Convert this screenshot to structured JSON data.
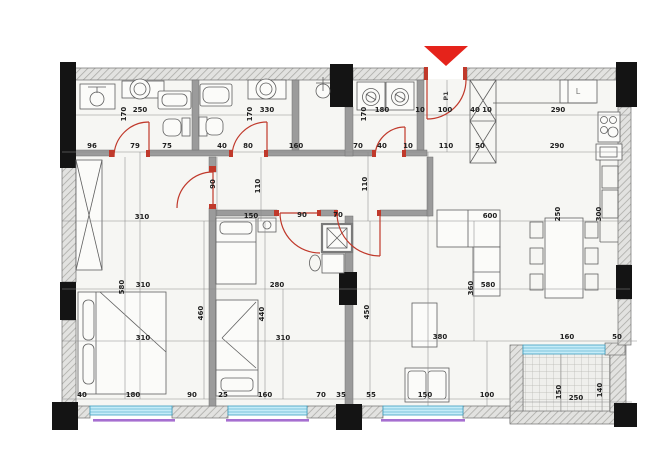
{
  "title": "Apartment floor plan drawing",
  "colors": {
    "background": "#ffffff",
    "floor": "#f6f6f3",
    "wall_hatch": "#e2e2e0",
    "wall_hatch_line": "#a8a8a4",
    "structural_column": "#141414",
    "interior_wall": "#9b9b9b",
    "door_red": "#c0392b",
    "entrance_marker_red": "#e5231b",
    "window_glass_blue": "#c5ecf8",
    "window_frame_blue": "#3b9dbf",
    "window_accent_purple": "#a66fd0",
    "balcony_tile": "#efefec",
    "dimension_text": "#1e1e1e"
  },
  "entrance": {
    "door_label": "P1",
    "marker": "red-triangle-pointing-down"
  },
  "fixtures": {
    "refrigerator_label": "L"
  },
  "annotations": [
    {
      "t": "170",
      "x": 126,
      "y": 114,
      "r": -90
    },
    {
      "t": "250",
      "x": 140,
      "y": 112
    },
    {
      "t": "170",
      "x": 252,
      "y": 114,
      "r": -90
    },
    {
      "t": "330",
      "x": 267,
      "y": 112
    },
    {
      "t": "170",
      "x": 366,
      "y": 114,
      "r": -90
    },
    {
      "t": "180",
      "x": 382,
      "y": 112
    },
    {
      "t": "10",
      "x": 420,
      "y": 112
    },
    {
      "t": "100",
      "x": 445,
      "y": 112
    },
    {
      "t": "40",
      "x": 475,
      "y": 112
    },
    {
      "t": "10",
      "x": 487,
      "y": 112
    },
    {
      "t": "290",
      "x": 558,
      "y": 112
    },
    {
      "t": "96",
      "x": 92,
      "y": 148
    },
    {
      "t": "79",
      "x": 135,
      "y": 148
    },
    {
      "t": "75",
      "x": 167,
      "y": 148
    },
    {
      "t": "40",
      "x": 222,
      "y": 148
    },
    {
      "t": "80",
      "x": 248,
      "y": 148
    },
    {
      "t": "160",
      "x": 296,
      "y": 148
    },
    {
      "t": "70",
      "x": 358,
      "y": 148
    },
    {
      "t": "40",
      "x": 382,
      "y": 148
    },
    {
      "t": "10",
      "x": 408,
      "y": 148
    },
    {
      "t": "110",
      "x": 446,
      "y": 148
    },
    {
      "t": "50",
      "x": 480,
      "y": 148
    },
    {
      "t": "290",
      "x": 557,
      "y": 148
    },
    {
      "t": "90",
      "x": 215,
      "y": 184,
      "r": -90
    },
    {
      "t": "110",
      "x": 260,
      "y": 186,
      "r": -90
    },
    {
      "t": "110",
      "x": 367,
      "y": 184,
      "r": -90
    },
    {
      "t": "310",
      "x": 142,
      "y": 219
    },
    {
      "t": "150",
      "x": 251,
      "y": 218
    },
    {
      "t": "90",
      "x": 302,
      "y": 217
    },
    {
      "t": "70",
      "x": 338,
      "y": 217
    },
    {
      "t": "600",
      "x": 490,
      "y": 218
    },
    {
      "t": "250",
      "x": 560,
      "y": 214,
      "r": -90
    },
    {
      "t": "300",
      "x": 601,
      "y": 214,
      "r": -90
    },
    {
      "t": "580",
      "x": 124,
      "y": 287,
      "r": -90
    },
    {
      "t": "310",
      "x": 143,
      "y": 287
    },
    {
      "t": "280",
      "x": 277,
      "y": 287
    },
    {
      "t": "360",
      "x": 473,
      "y": 288,
      "r": -90
    },
    {
      "t": "580",
      "x": 488,
      "y": 287
    },
    {
      "t": "460",
      "x": 203,
      "y": 313,
      "r": -90
    },
    {
      "t": "440",
      "x": 264,
      "y": 314,
      "r": -90
    },
    {
      "t": "450",
      "x": 369,
      "y": 312,
      "r": -90
    },
    {
      "t": "310",
      "x": 143,
      "y": 340
    },
    {
      "t": "310",
      "x": 283,
      "y": 340
    },
    {
      "t": "380",
      "x": 440,
      "y": 339
    },
    {
      "t": "160",
      "x": 567,
      "y": 339
    },
    {
      "t": "50",
      "x": 617,
      "y": 339
    },
    {
      "t": "40",
      "x": 82,
      "y": 397
    },
    {
      "t": "180",
      "x": 133,
      "y": 397
    },
    {
      "t": "90",
      "x": 192,
      "y": 397
    },
    {
      "t": "25",
      "x": 223,
      "y": 397
    },
    {
      "t": "160",
      "x": 265,
      "y": 397
    },
    {
      "t": "70",
      "x": 321,
      "y": 397
    },
    {
      "t": "35",
      "x": 341,
      "y": 397
    },
    {
      "t": "55",
      "x": 371,
      "y": 397
    },
    {
      "t": "150",
      "x": 425,
      "y": 397
    },
    {
      "t": "100",
      "x": 487,
      "y": 397
    },
    {
      "t": "250",
      "x": 576,
      "y": 400
    },
    {
      "t": "150",
      "x": 561,
      "y": 392,
      "r": -90
    },
    {
      "t": "140",
      "x": 602,
      "y": 390,
      "r": -90
    },
    {
      "t": "P1",
      "x": 448,
      "y": 96,
      "r": -90,
      "k": "door"
    },
    {
      "t": "L",
      "x": 578,
      "y": 94,
      "k": "fixture"
    }
  ]
}
